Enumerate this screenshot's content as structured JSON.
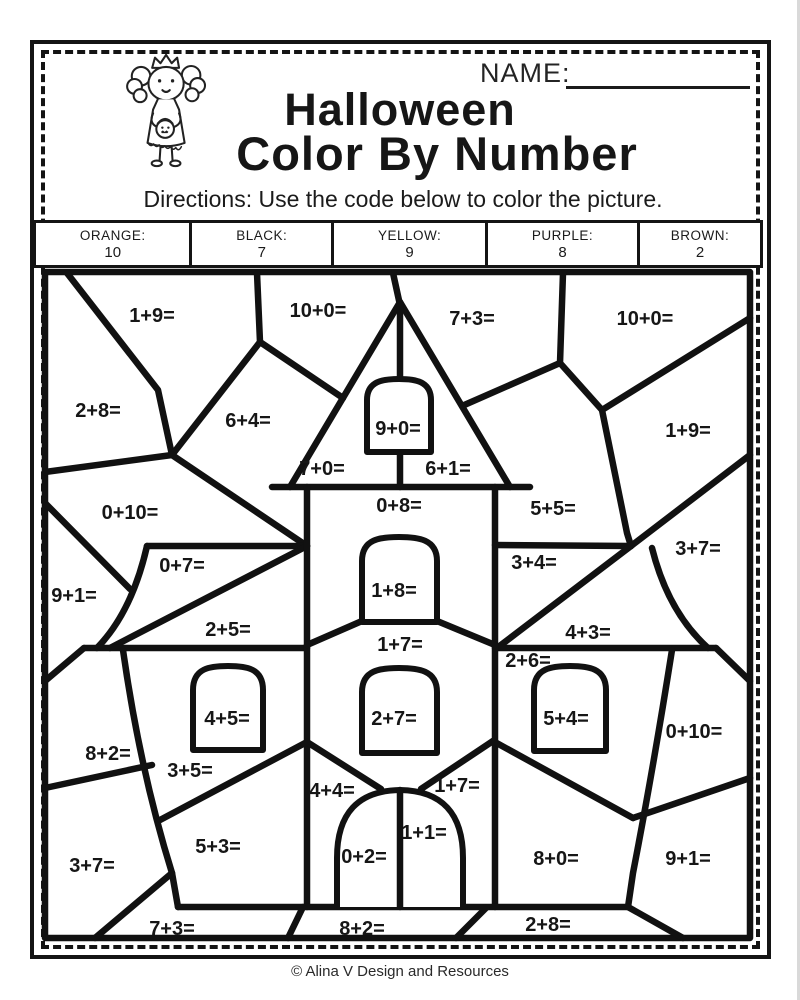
{
  "header": {
    "name_label": "NAME:",
    "title_line1": "Halloween",
    "title_line2": "Color By Number",
    "directions": "Directions: Use the code below to color the picture."
  },
  "code_table": {
    "cells": [
      {
        "color_label": "ORANGE:",
        "value": "10"
      },
      {
        "color_label": "BLACK:",
        "value": "7"
      },
      {
        "color_label": "YELLOW:",
        "value": "9"
      },
      {
        "color_label": "PURPLE:",
        "value": "8"
      },
      {
        "color_label": "BROWN:",
        "value": "2"
      }
    ]
  },
  "picture": {
    "description": "Haunted house color-by-number line art with addition equations in each region",
    "labels": [
      {
        "text": "1+9=",
        "x": 152,
        "y": 322
      },
      {
        "text": "10+0=",
        "x": 318,
        "y": 317
      },
      {
        "text": "7+3=",
        "x": 472,
        "y": 325
      },
      {
        "text": "10+0=",
        "x": 645,
        "y": 325
      },
      {
        "text": "2+8=",
        "x": 98,
        "y": 417
      },
      {
        "text": "6+4=",
        "x": 248,
        "y": 427
      },
      {
        "text": "9+0=",
        "x": 398,
        "y": 435
      },
      {
        "text": "1+9=",
        "x": 688,
        "y": 437
      },
      {
        "text": "7+0=",
        "x": 322,
        "y": 475
      },
      {
        "text": "6+1=",
        "x": 448,
        "y": 475
      },
      {
        "text": "0+10=",
        "x": 130,
        "y": 519
      },
      {
        "text": "0+8=",
        "x": 399,
        "y": 512
      },
      {
        "text": "5+5=",
        "x": 553,
        "y": 515
      },
      {
        "text": "3+7=",
        "x": 698,
        "y": 555
      },
      {
        "text": "0+7=",
        "x": 182,
        "y": 572
      },
      {
        "text": "3+4=",
        "x": 534,
        "y": 569
      },
      {
        "text": "9+1=",
        "x": 74,
        "y": 602
      },
      {
        "text": "1+8=",
        "x": 394,
        "y": 597
      },
      {
        "text": "2+5=",
        "x": 228,
        "y": 636
      },
      {
        "text": "4+3=",
        "x": 588,
        "y": 639
      },
      {
        "text": "1+7=",
        "x": 400,
        "y": 651
      },
      {
        "text": "2+6=",
        "x": 528,
        "y": 667
      },
      {
        "text": "4+5=",
        "x": 227,
        "y": 725
      },
      {
        "text": "2+7=",
        "x": 394,
        "y": 725
      },
      {
        "text": "5+4=",
        "x": 566,
        "y": 725
      },
      {
        "text": "0+10=",
        "x": 694,
        "y": 738
      },
      {
        "text": "8+2=",
        "x": 108,
        "y": 760
      },
      {
        "text": "3+5=",
        "x": 190,
        "y": 777
      },
      {
        "text": "4+4=",
        "x": 332,
        "y": 797
      },
      {
        "text": "1+7=",
        "x": 457,
        "y": 792
      },
      {
        "text": "5+3=",
        "x": 218,
        "y": 853
      },
      {
        "text": "1+1=",
        "x": 424,
        "y": 839
      },
      {
        "text": "0+2=",
        "x": 364,
        "y": 863
      },
      {
        "text": "8+0=",
        "x": 556,
        "y": 865
      },
      {
        "text": "3+7=",
        "x": 92,
        "y": 872
      },
      {
        "text": "9+1=",
        "x": 688,
        "y": 865
      },
      {
        "text": "7+3=",
        "x": 172,
        "y": 935
      },
      {
        "text": "8+2=",
        "x": 362,
        "y": 935
      },
      {
        "text": "2+8=",
        "x": 548,
        "y": 931
      }
    ]
  },
  "footer": {
    "credit": "© Alina V Design and Resources"
  }
}
